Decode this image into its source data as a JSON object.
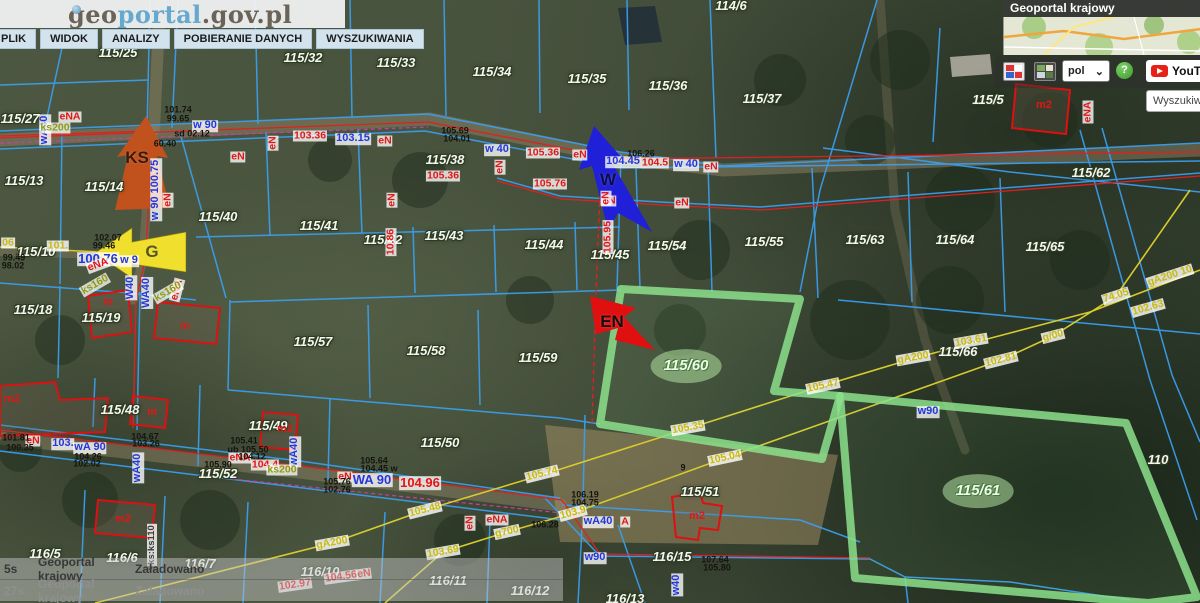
{
  "header": {
    "logo": {
      "geo": "geo",
      "portal": "portal",
      "suffix": ".gov.pl"
    },
    "menu": [
      "PLIK",
      "WIDOK",
      "ANALIZY",
      "POBIERANIE DANYCH",
      "WYSZUKIWANIA"
    ]
  },
  "panel": {
    "title": "Geoportal krajowy",
    "lang": "pol",
    "help": "?",
    "youtube": "YouTube",
    "search": "Wyszukiw",
    "buttons": [
      "composition-switcher",
      "basemap-switcher"
    ]
  },
  "statusbar": [
    {
      "time": "5s",
      "source": "Geoportal krajowy",
      "status": "Załadowano"
    },
    {
      "time": "27s",
      "source": "Geoportal krajowy",
      "status": "Załadowano"
    }
  ],
  "colors": {
    "parcel_line": "#3aa0f2",
    "power_line": "#e02020",
    "water_line": "#2337dd",
    "gas_line": "#d6ca2e",
    "sewer": "#8f9c10",
    "highlight": "#90dc8c",
    "arrow_ks": "#c1511d",
    "arrow_g": "#f0df2c",
    "arrow_w": "#2020d8",
    "arrow_en": "#e01010"
  },
  "map": {
    "highlighted_parcels": [
      "115/60",
      "115/61"
    ],
    "labels": [
      {
        "t": "115/25",
        "x": 118,
        "y": 53,
        "c": "p"
      },
      {
        "t": "115/27",
        "x": 20,
        "y": 119,
        "c": "p"
      },
      {
        "t": "115/32",
        "x": 303,
        "y": 58,
        "c": "p"
      },
      {
        "t": "115/33",
        "x": 396,
        "y": 63,
        "c": "p"
      },
      {
        "t": "115/34",
        "x": 492,
        "y": 72,
        "c": "p"
      },
      {
        "t": "115/35",
        "x": 587,
        "y": 79,
        "c": "p"
      },
      {
        "t": "115/36",
        "x": 668,
        "y": 86,
        "c": "p"
      },
      {
        "t": "115/37",
        "x": 762,
        "y": 99,
        "c": "p"
      },
      {
        "t": "115/5",
        "x": 988,
        "y": 100,
        "c": "p"
      },
      {
        "t": "115/62",
        "x": 1091,
        "y": 173,
        "c": "p"
      },
      {
        "t": "115/13",
        "x": 24,
        "y": 181,
        "c": "p"
      },
      {
        "t": "115/14",
        "x": 104,
        "y": 187,
        "c": "p"
      },
      {
        "t": "115/38",
        "x": 445,
        "y": 160,
        "c": "p"
      },
      {
        "t": "115/40",
        "x": 218,
        "y": 217,
        "c": "p"
      },
      {
        "t": "115/41",
        "x": 319,
        "y": 226,
        "c": "p"
      },
      {
        "t": "115/42",
        "x": 383,
        "y": 240,
        "c": "p"
      },
      {
        "t": "115/43",
        "x": 444,
        "y": 236,
        "c": "p"
      },
      {
        "t": "115/44",
        "x": 544,
        "y": 245,
        "c": "p"
      },
      {
        "t": "115/45",
        "x": 610,
        "y": 255,
        "c": "p"
      },
      {
        "t": "115/54",
        "x": 667,
        "y": 246,
        "c": "p"
      },
      {
        "t": "115/55",
        "x": 764,
        "y": 242,
        "c": "p"
      },
      {
        "t": "115/63",
        "x": 865,
        "y": 240,
        "c": "p"
      },
      {
        "t": "115/64",
        "x": 955,
        "y": 240,
        "c": "p"
      },
      {
        "t": "115/65",
        "x": 1045,
        "y": 247,
        "c": "p"
      },
      {
        "t": "115/66",
        "x": 958,
        "y": 352,
        "c": "p"
      },
      {
        "t": "115/10",
        "x": 36,
        "y": 252,
        "c": "p"
      },
      {
        "t": "115/18",
        "x": 33,
        "y": 310,
        "c": "p"
      },
      {
        "t": "115/19",
        "x": 101,
        "y": 318,
        "c": "p"
      },
      {
        "t": "115/57",
        "x": 313,
        "y": 342,
        "c": "p"
      },
      {
        "t": "115/58",
        "x": 426,
        "y": 351,
        "c": "p"
      },
      {
        "t": "115/59",
        "x": 538,
        "y": 358,
        "c": "p"
      },
      {
        "t": "115/50",
        "x": 440,
        "y": 443,
        "c": "p"
      },
      {
        "t": "115/48",
        "x": 120,
        "y": 410,
        "c": "p"
      },
      {
        "t": "115/49",
        "x": 268,
        "y": 426,
        "c": "p"
      },
      {
        "t": "115/52",
        "x": 218,
        "y": 474,
        "c": "p"
      },
      {
        "t": "115/51",
        "x": 700,
        "y": 492,
        "c": "p"
      },
      {
        "t": "116/5",
        "x": 45,
        "y": 554,
        "c": "p"
      },
      {
        "t": "116/6",
        "x": 122,
        "y": 558,
        "c": "p"
      },
      {
        "t": "116/7",
        "x": 200,
        "y": 564,
        "c": "p"
      },
      {
        "t": "116/10",
        "x": 320,
        "y": 572,
        "c": "p"
      },
      {
        "t": "116/11",
        "x": 448,
        "y": 581,
        "c": "p"
      },
      {
        "t": "116/12",
        "x": 530,
        "y": 591,
        "c": "p"
      },
      {
        "t": "116/13",
        "x": 625,
        "y": 599,
        "c": "p"
      },
      {
        "t": "116/15",
        "x": 672,
        "y": 557,
        "c": "p"
      },
      {
        "t": "110",
        "x": 1158,
        "y": 460,
        "c": "p"
      },
      {
        "t": "114/6",
        "x": 731,
        "y": 6,
        "c": "p"
      },
      {
        "t": "115/60",
        "x": 686,
        "y": 366,
        "c": "pg"
      },
      {
        "t": "115/61",
        "x": 978,
        "y": 491,
        "c": "pg"
      },
      {
        "t": "w 90",
        "x": 205,
        "y": 126,
        "c": "b"
      },
      {
        "t": "100.76",
        "x": 98,
        "y": 259,
        "c": "b",
        "fs": 13
      },
      {
        "t": "w 9",
        "x": 129,
        "y": 261,
        "c": "b"
      },
      {
        "t": "W40",
        "x": 131,
        "y": 288,
        "c": "b",
        "r": -90
      },
      {
        "t": "WA40",
        "x": 147,
        "y": 293,
        "c": "b",
        "r": -90
      },
      {
        "t": "w 90 100.75",
        "x": 156,
        "y": 190,
        "c": "b",
        "r": -90
      },
      {
        "t": "w 40",
        "x": 497,
        "y": 150,
        "c": "b"
      },
      {
        "t": "104.45",
        "x": 623,
        "y": 162,
        "c": "b"
      },
      {
        "t": "w 40",
        "x": 686,
        "y": 165,
        "c": "b"
      },
      {
        "t": "103.15",
        "x": 353,
        "y": 139,
        "c": "b"
      },
      {
        "t": "WA 90",
        "x": 372,
        "y": 480,
        "c": "b",
        "fs": 13
      },
      {
        "t": "wA 90",
        "x": 90,
        "y": 448,
        "c": "b"
      },
      {
        "t": "w90",
        "x": 595,
        "y": 558,
        "c": "b"
      },
      {
        "t": "w90",
        "x": 928,
        "y": 412,
        "c": "b"
      },
      {
        "t": "wA40",
        "x": 598,
        "y": 522,
        "c": "b"
      },
      {
        "t": "wA40",
        "x": 138,
        "y": 468,
        "c": "b",
        "r": -90
      },
      {
        "t": "wA40",
        "x": 45,
        "y": 130,
        "c": "b",
        "r": -90
      },
      {
        "t": "w40",
        "x": 677,
        "y": 585,
        "c": "b",
        "r": -90
      },
      {
        "t": "wA40",
        "x": 295,
        "y": 452,
        "c": "b",
        "r": -90
      },
      {
        "t": "103.",
        "x": 63,
        "y": 444,
        "c": "b"
      },
      {
        "t": "eNA",
        "x": 70,
        "y": 117,
        "c": "r"
      },
      {
        "t": "eN",
        "x": 238,
        "y": 157,
        "c": "r"
      },
      {
        "t": "eN",
        "x": 273,
        "y": 143,
        "c": "r",
        "r": -90
      },
      {
        "t": "eN",
        "x": 168,
        "y": 200,
        "c": "r",
        "r": -90
      },
      {
        "t": "103.36",
        "x": 310,
        "y": 136,
        "c": "r"
      },
      {
        "t": "eN",
        "x": 385,
        "y": 141,
        "c": "r"
      },
      {
        "t": "105.36",
        "x": 543,
        "y": 153,
        "c": "r"
      },
      {
        "t": "eN",
        "x": 580,
        "y": 155,
        "c": "r"
      },
      {
        "t": "105.36",
        "x": 443,
        "y": 176,
        "c": "r"
      },
      {
        "t": "105.76",
        "x": 550,
        "y": 184,
        "c": "r"
      },
      {
        "t": "eN",
        "x": 609,
        "y": 201,
        "c": "r"
      },
      {
        "t": "eN",
        "x": 682,
        "y": 203,
        "c": "r"
      },
      {
        "t": "eN",
        "x": 500,
        "y": 167,
        "c": "r",
        "r": -90
      },
      {
        "t": "eN",
        "x": 711,
        "y": 167,
        "c": "r"
      },
      {
        "t": "104.5",
        "x": 655,
        "y": 163,
        "c": "r"
      },
      {
        "t": "eN",
        "x": 606,
        "y": 198,
        "c": "r",
        "r": -90
      },
      {
        "t": "105.95",
        "x": 608,
        "y": 237,
        "c": "r",
        "r": -90
      },
      {
        "t": "eN",
        "x": 392,
        "y": 200,
        "c": "r",
        "r": -90
      },
      {
        "t": "10.86",
        "x": 391,
        "y": 242,
        "c": "r",
        "r": -90
      },
      {
        "t": "eNA",
        "x": 98,
        "y": 265,
        "c": "r",
        "r": -20
      },
      {
        "t": "eNA",
        "x": 177,
        "y": 290,
        "c": "r",
        "r": -75
      },
      {
        "t": "eN",
        "x": 345,
        "y": 477,
        "c": "r"
      },
      {
        "t": "eN",
        "x": 33,
        "y": 441,
        "c": "r"
      },
      {
        "t": "eNA",
        "x": 240,
        "y": 458,
        "c": "r"
      },
      {
        "t": "104.4",
        "x": 265,
        "y": 465,
        "c": "r"
      },
      {
        "t": "A",
        "x": 625,
        "y": 522,
        "c": "r"
      },
      {
        "t": "102.97",
        "x": 295,
        "y": 585,
        "c": "r",
        "r": -8
      },
      {
        "t": "104.56",
        "x": 341,
        "y": 577,
        "c": "r",
        "r": -8
      },
      {
        "t": "eN",
        "x": 364,
        "y": 574,
        "c": "r",
        "r": -8
      },
      {
        "t": "eN",
        "x": 1133,
        "y": 48,
        "c": "r",
        "r": -10
      },
      {
        "t": "eNA",
        "x": 1088,
        "y": 112,
        "c": "r",
        "r": -90
      },
      {
        "t": "104.96",
        "x": 420,
        "y": 483,
        "c": "r",
        "fs": 13
      },
      {
        "t": "eNA",
        "x": 497,
        "y": 520,
        "c": "r"
      },
      {
        "t": "eN",
        "x": 470,
        "y": 523,
        "c": "r",
        "r": -90
      },
      {
        "t": "ks200",
        "x": 55,
        "y": 128,
        "c": "o"
      },
      {
        "t": "ks160",
        "x": 95,
        "y": 285,
        "c": "o",
        "r": -30
      },
      {
        "t": "ks160",
        "x": 168,
        "y": 292,
        "c": "o",
        "r": -30
      },
      {
        "t": "ks200",
        "x": 282,
        "y": 470,
        "c": "o"
      },
      {
        "t": "ks:ks110",
        "x": 152,
        "y": 545,
        "c": "wv",
        "r": -90
      },
      {
        "t": "06",
        "x": 8,
        "y": 243,
        "c": "y"
      },
      {
        "t": "101.",
        "x": 58,
        "y": 246,
        "c": "y"
      },
      {
        "t": "gA200",
        "x": 332,
        "y": 543,
        "c": "y",
        "r": -10
      },
      {
        "t": "105.48",
        "x": 425,
        "y": 510,
        "c": "y",
        "r": -14
      },
      {
        "t": "103.69",
        "x": 443,
        "y": 552,
        "c": "y",
        "r": -10
      },
      {
        "t": "g700",
        "x": 507,
        "y": 532,
        "c": "y",
        "r": -12
      },
      {
        "t": "103.9",
        "x": 573,
        "y": 513,
        "c": "y",
        "r": -15
      },
      {
        "t": "105.74",
        "x": 542,
        "y": 474,
        "c": "y",
        "r": -14
      },
      {
        "t": "105.35",
        "x": 688,
        "y": 428,
        "c": "y",
        "r": -10
      },
      {
        "t": "105.47",
        "x": 823,
        "y": 386,
        "c": "y",
        "r": -12
      },
      {
        "t": "105.04",
        "x": 725,
        "y": 458,
        "c": "y",
        "r": -12
      },
      {
        "t": "gA200",
        "x": 913,
        "y": 358,
        "c": "y",
        "r": -10
      },
      {
        "t": "103.61",
        "x": 971,
        "y": 341,
        "c": "y",
        "r": -10
      },
      {
        "t": "g/00",
        "x": 1053,
        "y": 336,
        "c": "y",
        "r": -14
      },
      {
        "t": "102.81",
        "x": 1001,
        "y": 360,
        "c": "y",
        "r": -14
      },
      {
        "t": "102.63",
        "x": 1148,
        "y": 308,
        "c": "y",
        "r": -16
      },
      {
        "t": "74.05",
        "x": 1116,
        "y": 296,
        "c": "y",
        "r": -18
      },
      {
        "t": "gA200 10",
        "x": 1170,
        "y": 276,
        "c": "y",
        "r": -18
      },
      {
        "t": "101.74",
        "x": 178,
        "y": 110,
        "c": "k"
      },
      {
        "t": "99.65",
        "x": 178,
        "y": 119,
        "c": "k"
      },
      {
        "t": "sd 02.12",
        "x": 192,
        "y": 134,
        "c": "k"
      },
      {
        "t": "60.40",
        "x": 165,
        "y": 144,
        "c": "k"
      },
      {
        "t": "102.07",
        "x": 108,
        "y": 238,
        "c": "k"
      },
      {
        "t": "99.46",
        "x": 104,
        "y": 246,
        "c": "k"
      },
      {
        "t": "99.49",
        "x": 14,
        "y": 258,
        "c": "k"
      },
      {
        "t": "98.02",
        "x": 13,
        "y": 266,
        "c": "k"
      },
      {
        "t": "105.69",
        "x": 455,
        "y": 131,
        "c": "k"
      },
      {
        "t": "104.01",
        "x": 457,
        "y": 139,
        "c": "k"
      },
      {
        "t": "106.26",
        "x": 641,
        "y": 154,
        "c": "k"
      },
      {
        "t": "105.64",
        "x": 374,
        "y": 461,
        "c": "k"
      },
      {
        "t": "104.45 w",
        "x": 379,
        "y": 469,
        "c": "k"
      },
      {
        "t": "105.76",
        "x": 337,
        "y": 482,
        "c": "k"
      },
      {
        "t": "102.76",
        "x": 337,
        "y": 490,
        "c": "k"
      },
      {
        "t": "106.19",
        "x": 585,
        "y": 495,
        "c": "k"
      },
      {
        "t": "104.75",
        "x": 585,
        "y": 503,
        "c": "k"
      },
      {
        "t": "106.28",
        "x": 545,
        "y": 525,
        "c": "k"
      },
      {
        "t": "107.64",
        "x": 715,
        "y": 560,
        "c": "k"
      },
      {
        "t": "105.80",
        "x": 717,
        "y": 568,
        "c": "k"
      },
      {
        "t": "9",
        "x": 683,
        "y": 468,
        "c": "k"
      },
      {
        "t": "104.67",
        "x": 145,
        "y": 437,
        "c": "k"
      },
      {
        "t": "103.26",
        "x": 146,
        "y": 444,
        "c": "k"
      },
      {
        "t": "105.41",
        "x": 244,
        "y": 441,
        "c": "k"
      },
      {
        "t": "ub 105.50",
        "x": 248,
        "y": 450,
        "c": "k"
      },
      {
        "t": "104.12",
        "x": 252,
        "y": 457,
        "c": "k"
      },
      {
        "t": "105.90",
        "x": 218,
        "y": 465,
        "c": "k"
      },
      {
        "t": "104.26",
        "x": 88,
        "y": 457,
        "c": "k"
      },
      {
        "t": "102.02",
        "x": 87,
        "y": 464,
        "c": "k"
      },
      {
        "t": "101.81",
        "x": 16,
        "y": 438,
        "c": "k"
      },
      {
        "t": "100.35",
        "x": 20,
        "y": 448,
        "c": "k"
      },
      {
        "t": "m2",
        "x": 1044,
        "y": 106,
        "c": "rp"
      },
      {
        "t": "m",
        "x": 108,
        "y": 303,
        "c": "rp"
      },
      {
        "t": "m",
        "x": 185,
        "y": 327,
        "c": "rp"
      },
      {
        "t": "m",
        "x": 152,
        "y": 413,
        "c": "rp"
      },
      {
        "t": "m2",
        "x": 285,
        "y": 430,
        "c": "rp"
      },
      {
        "t": "m2",
        "x": 12,
        "y": 400,
        "c": "rp"
      },
      {
        "t": "m2",
        "x": 123,
        "y": 520,
        "c": "rp"
      },
      {
        "t": "m2",
        "x": 697,
        "y": 517,
        "c": "rp"
      },
      {
        "t": "KS",
        "x": 137,
        "y": 158,
        "c": "at",
        "col": "#3a1b08"
      },
      {
        "t": "G",
        "x": 152,
        "y": 252,
        "c": "at",
        "col": "#55551e"
      },
      {
        "t": "W",
        "x": 608,
        "y": 180,
        "c": "at",
        "col": "#0d0d46"
      },
      {
        "t": "EN",
        "x": 612,
        "y": 322,
        "c": "at",
        "col": "#101010"
      }
    ]
  }
}
